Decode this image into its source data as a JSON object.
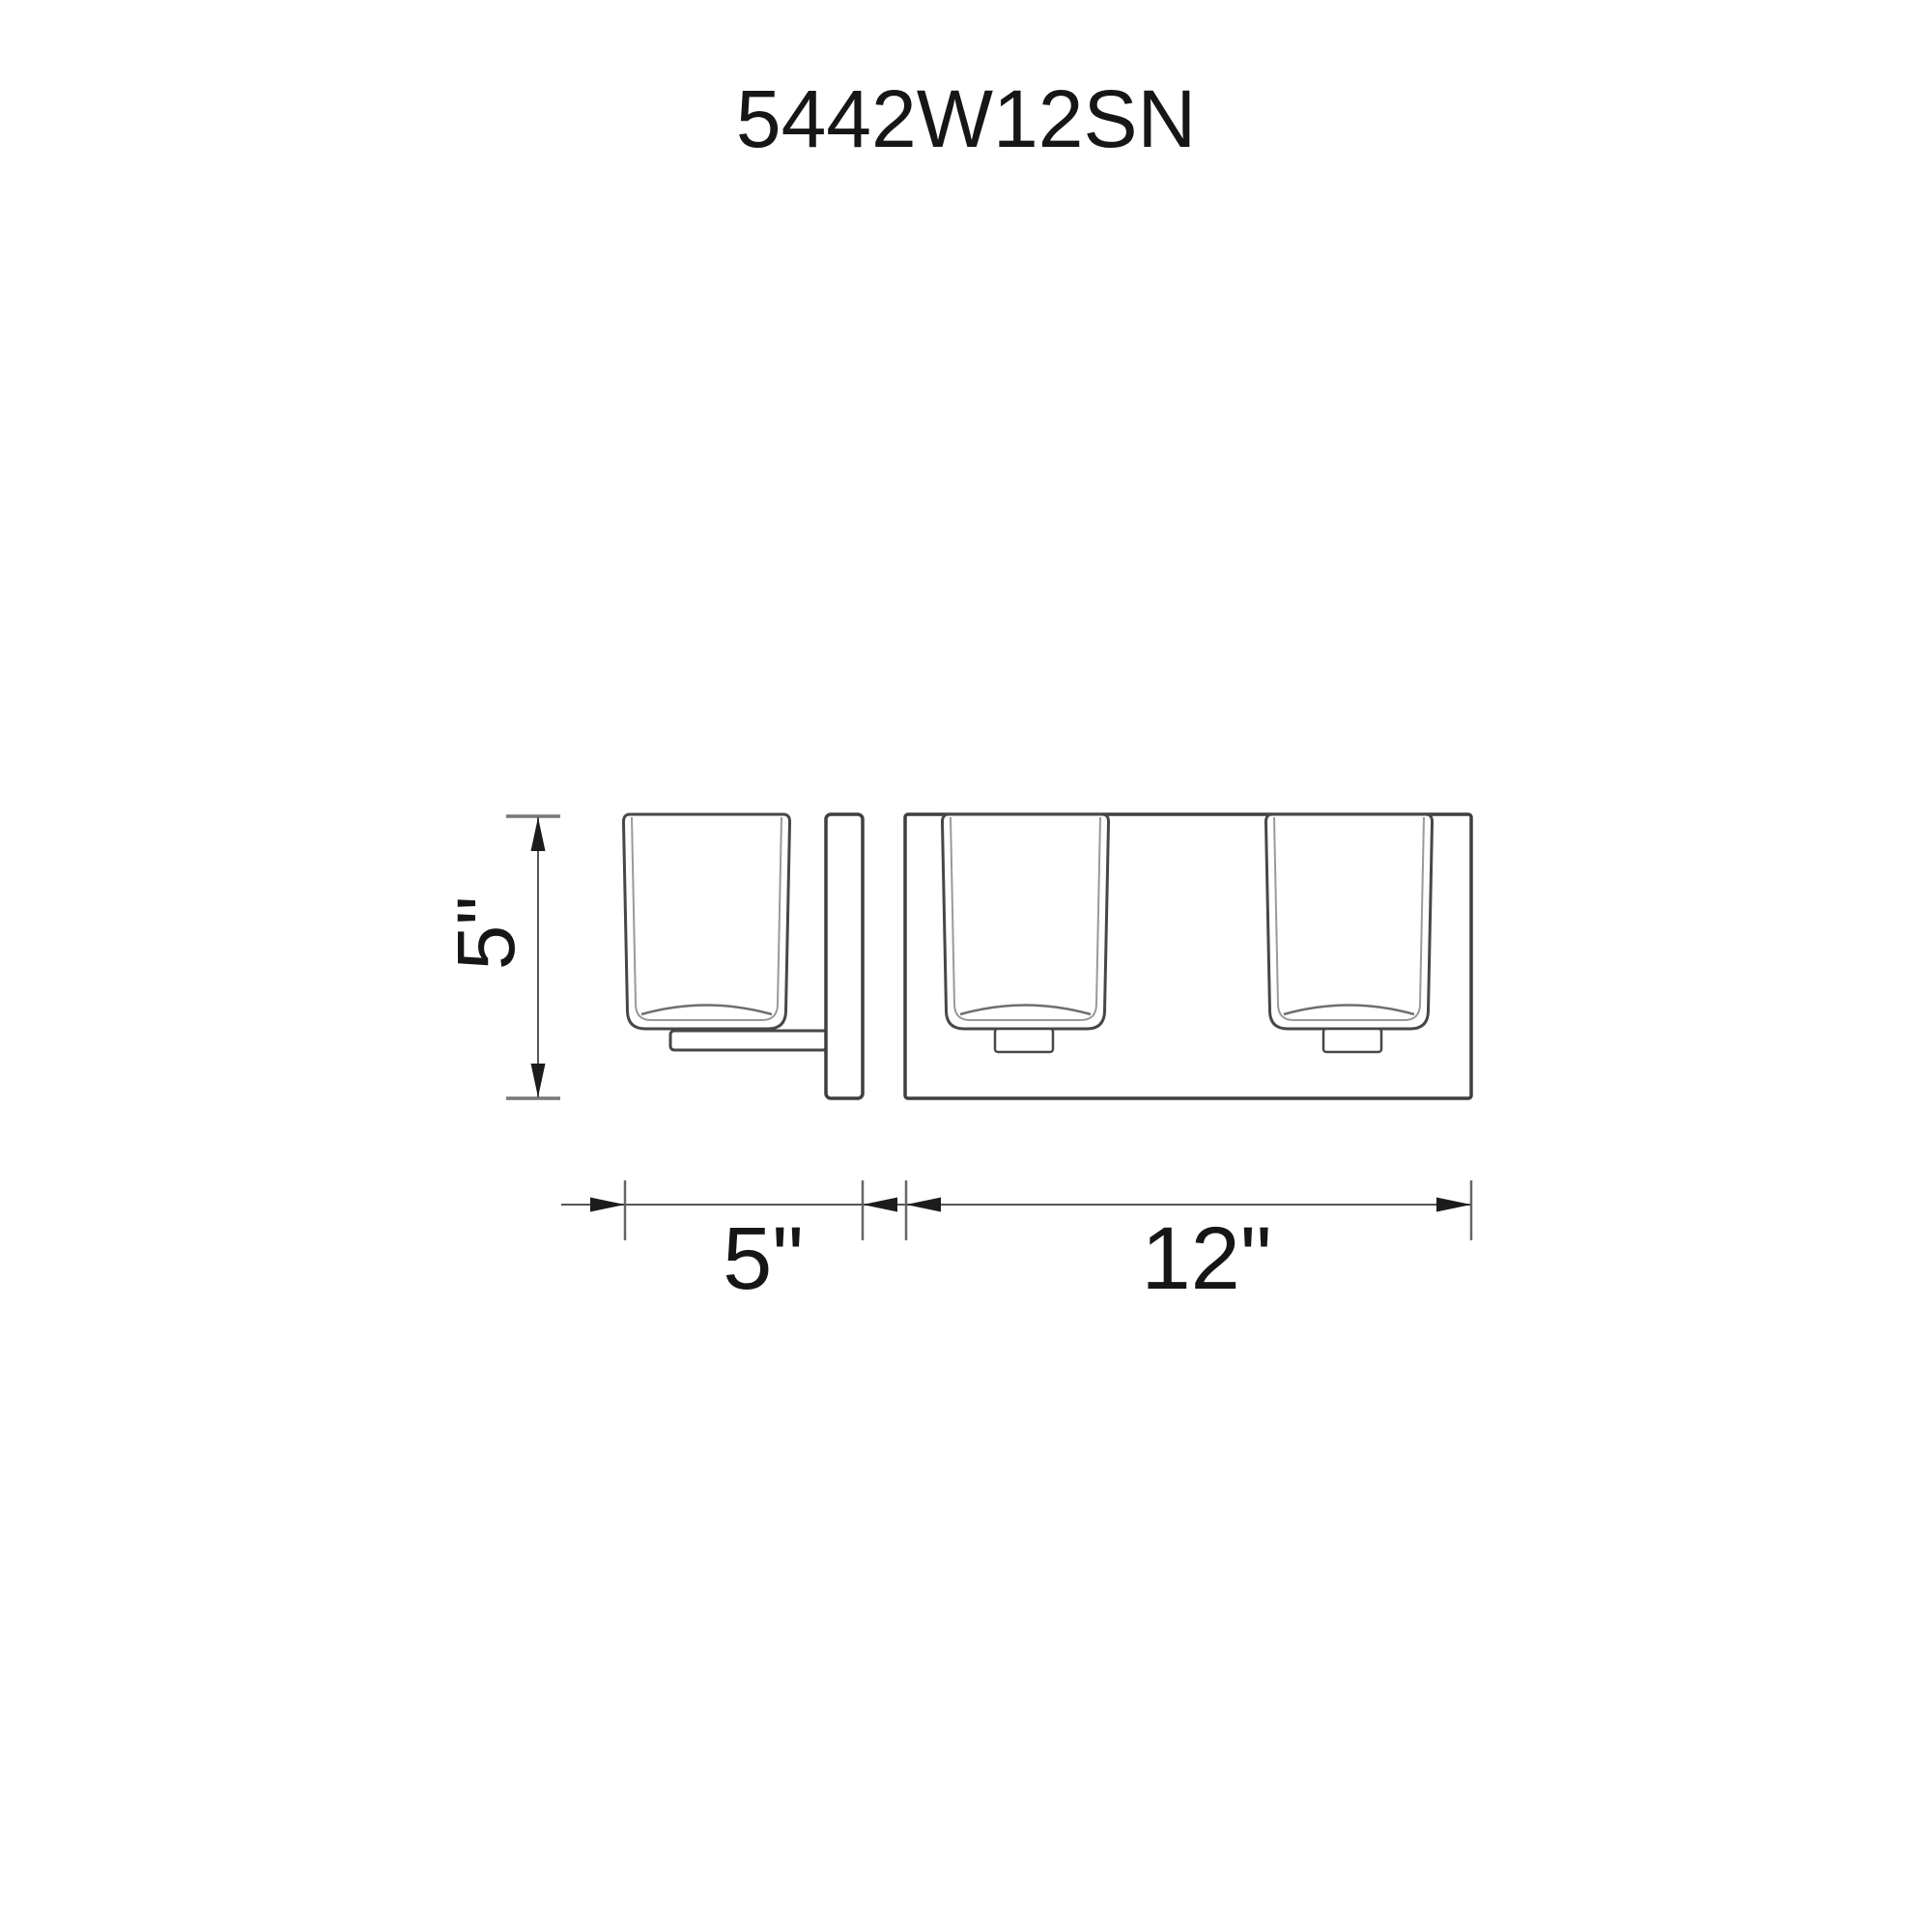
{
  "title": "5442W12SN",
  "drawing": {
    "type": "product-dimension-diagram",
    "subject": "2-light wall vanity fixture, side view and front view",
    "side_view": {
      "height_dimension": "5\""
    },
    "front_view": {
      "backplate_depth_dimension": "5\"",
      "fixture_width_dimension": "12\""
    }
  },
  "colors": {
    "background": "#ffffff",
    "object_line": "#474747",
    "inner_glass_line": "#9a9a9a",
    "dimension_line": "#555555",
    "arrow_and_text": "#161616"
  }
}
